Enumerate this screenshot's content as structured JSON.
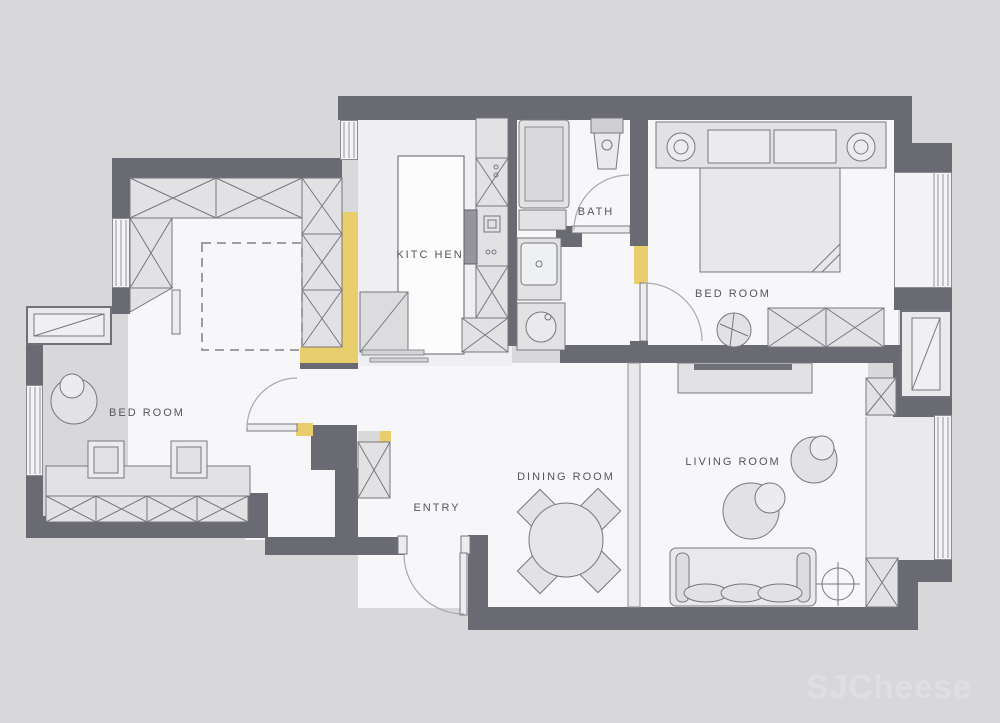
{
  "title": "apartment-floor-plan",
  "palette": {
    "background": "#d8d8db",
    "wall": "#6a6a72",
    "floor": "#f7f7f9",
    "accent_yellow": "#e9ce6d",
    "furniture_fill": "#e2e2e5",
    "furniture_line": "#77777e",
    "label_color": "#55555c"
  },
  "labels": {
    "kitchen": "KITC HEN",
    "bath": "BATH",
    "bedroom_main": "BED ROOM",
    "bedroom_left": "BED ROOM",
    "entry": "ENTRY",
    "dining": "DINING ROOM",
    "living": "LIVING ROOM"
  },
  "watermark": {
    "text": "SJCheese"
  },
  "furniture_icons": [
    "u-shaped-wardrobe",
    "dashed-bed-placeholder",
    "lounge-chair",
    "desk",
    "desk-chairs",
    "storage-cabinet-row",
    "bay-window",
    "shoe-cabinet",
    "entry-door",
    "kitchen-island",
    "kitchen-counter",
    "refrigerator",
    "cooktop",
    "shower",
    "toilet",
    "washbasin",
    "washing-machine",
    "bath-door",
    "double-bed",
    "headboard-nightstands",
    "pillows",
    "dresser",
    "stool",
    "bedroom-door",
    "dining-table",
    "dining-chairs",
    "tv-cabinet",
    "sofa",
    "armchair-with-ottoman",
    "floor-lamp",
    "balcony-cabinets",
    "ac-outdoor-unit",
    "window-glazing"
  ]
}
